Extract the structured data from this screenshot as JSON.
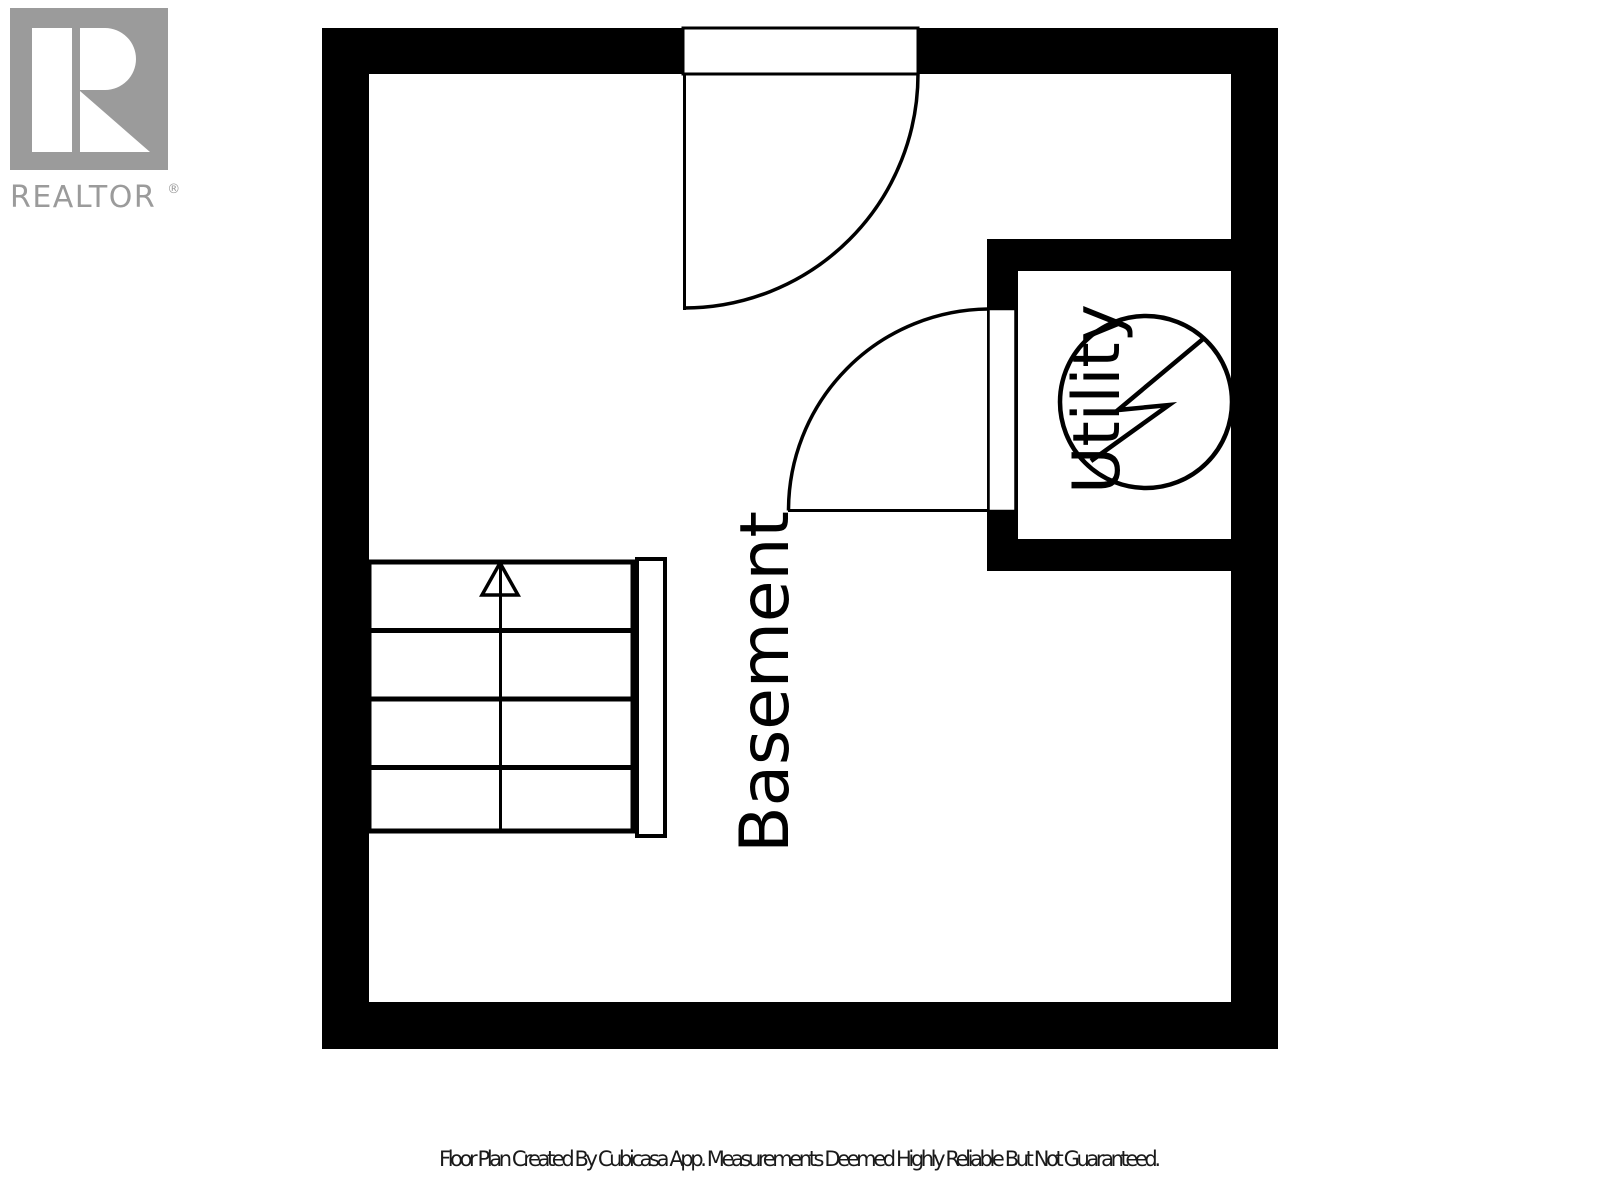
{
  "branding": {
    "logo_text": "REALTOR",
    "registered_mark": "®"
  },
  "plan": {
    "floor_label": "Basement",
    "rooms": [
      {
        "label": "Utility",
        "fixture": "water-heater"
      }
    ],
    "features": [
      "staircase-up",
      "entry-door",
      "utility-door"
    ]
  },
  "footer": {
    "disclaimer": "Floor Plan Created By Cubicasa App. Measurements Deemed Highly Reliable But Not Guaranteed."
  },
  "colors": {
    "wall": "#000000",
    "line": "#000000",
    "background": "#ffffff",
    "logo_gray": "#9b9b9b",
    "footer_text": "#1a1a1a"
  }
}
